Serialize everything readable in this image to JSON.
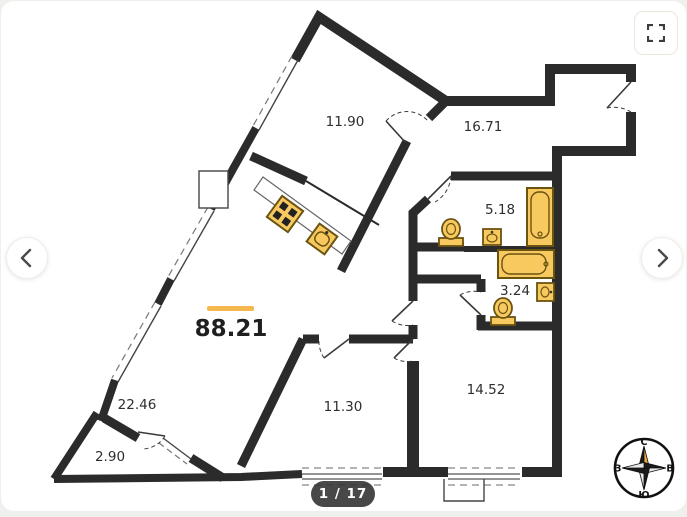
{
  "viewer": {
    "total_area": "88.21",
    "page_indicator": "1 / 17",
    "accent_color": "#F5B84F",
    "wall_color": "#2B2B2B",
    "fixture_fill": "#F8C95F",
    "fixture_stroke": "#6B5310"
  },
  "rooms": [
    {
      "id": "room-11-90",
      "area": "11.90"
    },
    {
      "id": "room-16-71",
      "area": "16.71"
    },
    {
      "id": "room-5-18",
      "area": "5.18"
    },
    {
      "id": "room-3-24",
      "area": "3.24"
    },
    {
      "id": "room-22-46",
      "area": "22.46"
    },
    {
      "id": "room-2-90",
      "area": "2.90"
    },
    {
      "id": "room-11-30",
      "area": "11.30"
    },
    {
      "id": "room-14-52",
      "area": "14.52"
    }
  ],
  "compass": {
    "north": "С",
    "east": "В",
    "south": "Ю",
    "west": "З"
  }
}
